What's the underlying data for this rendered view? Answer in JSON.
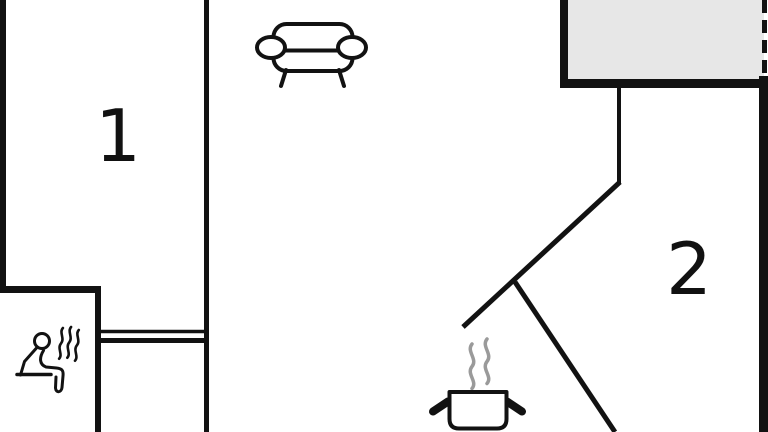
{
  "plan": {
    "type": "apartment-floor-plan",
    "rooms": [
      {
        "id": "room-1",
        "label": "1"
      },
      {
        "id": "room-2",
        "label": "2"
      }
    ],
    "icons": [
      {
        "name": "sofa-icon"
      },
      {
        "name": "sauna-icon"
      },
      {
        "name": "cooking-pot-icon"
      }
    ]
  },
  "colors": {
    "wall": "#121212",
    "background": "#ffffff",
    "balcony_fill": "#e7e7e7",
    "steam_gray": "#9a9a9a"
  }
}
